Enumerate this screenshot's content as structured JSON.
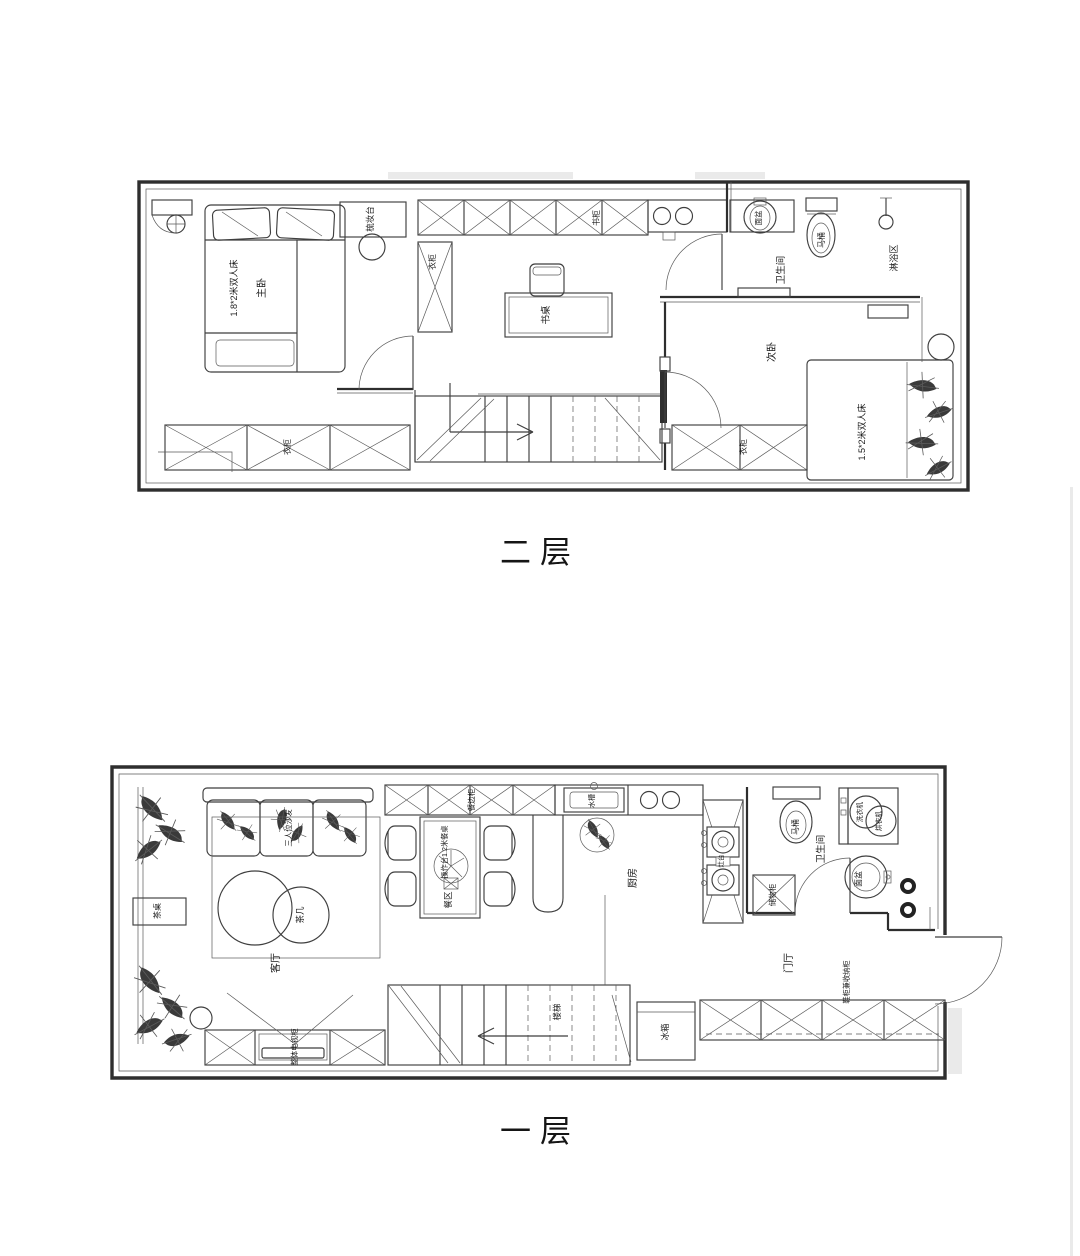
{
  "document": {
    "type": "residential floor plan, two levels",
    "colors": {
      "paper": "#ffffff",
      "line": "#3f3f3f",
      "wall": "#2e2e2e"
    }
  },
  "floor2": {
    "title": "二层",
    "labels": {
      "master_bed": "1.8*2米双人床",
      "master_bedroom": "主卧",
      "dressing_table": "梳妆台",
      "wardrobe_column": "衣柜",
      "bookcase": "书柜",
      "desk": "书桌",
      "wardrobe_left": "衣柜",
      "wardrobe_right": "衣柜",
      "bathroom": "卫生间",
      "toilet": "马桶",
      "basin": "面盆",
      "shower_area": "淋浴区",
      "second_bedroom": "次卧",
      "second_bed": "1.5*2米双人床"
    }
  },
  "floor1": {
    "title": "一层",
    "labels": {
      "tea_table": "茶桌",
      "sofa": "三人位沙发",
      "coffee_table": "茶几",
      "living_room": "客厅",
      "tv_cabinet": "整体电视柜",
      "sideboard": "餐边柜",
      "dining_table": "操作台1.2米餐桌",
      "dining_area": "餐区",
      "sink": "水槽",
      "kitchen": "厨房",
      "stove_column": "灶台",
      "storage": "储物柜",
      "toilet": "马桶",
      "bathroom": "卫生间",
      "washer": "洗衣机",
      "dryer": "烘衣机",
      "basin": "面盆",
      "foyer": "门厅",
      "shoe_cabinet": "鞋柜兼收纳柜",
      "fridge": "冰箱",
      "stairs": "楼梯"
    }
  }
}
